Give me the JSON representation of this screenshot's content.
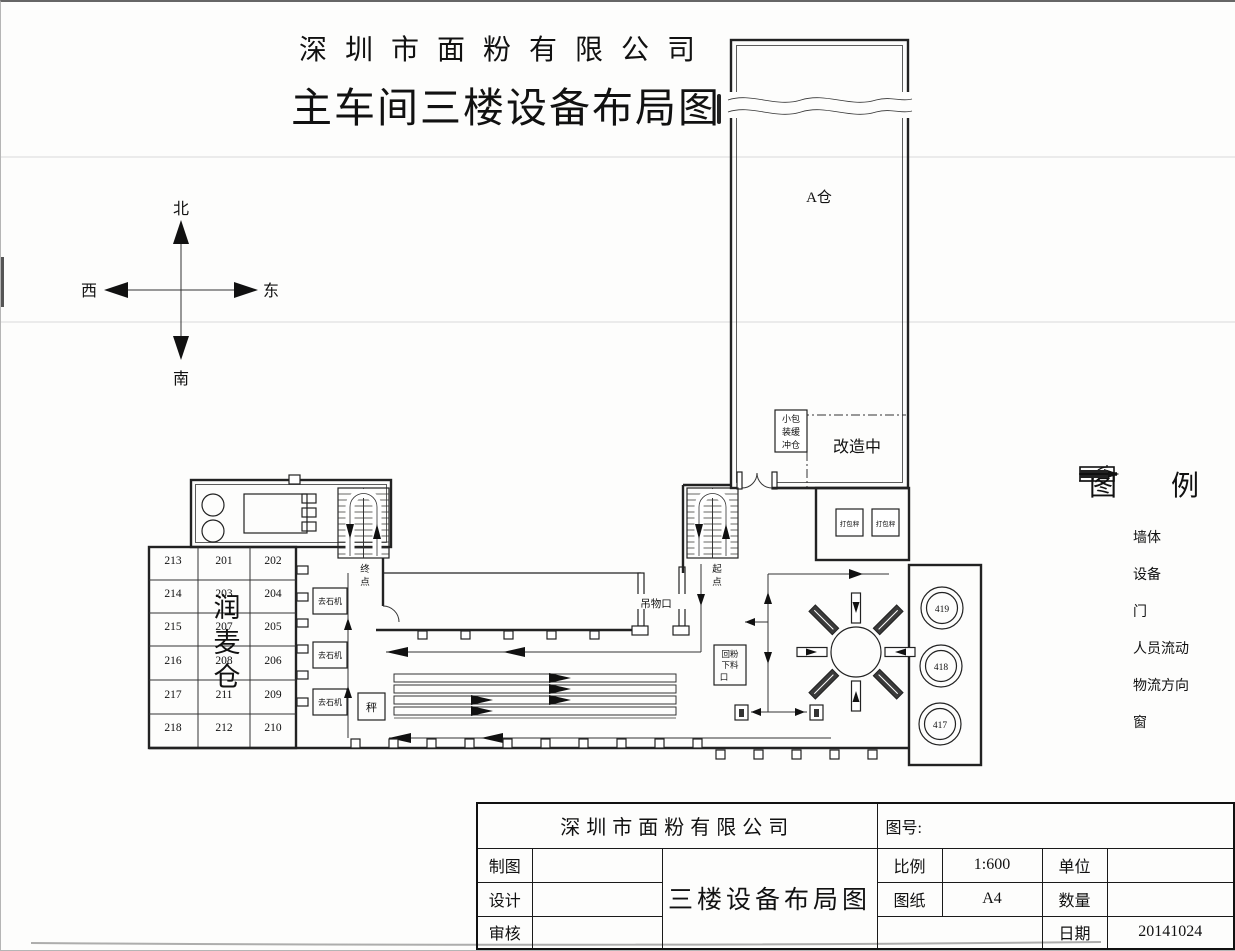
{
  "page": {
    "company": "深圳市面粉有限公司",
    "title": "主车间三楼设备布局图"
  },
  "compass": {
    "north": "北",
    "south": "南",
    "east": "东",
    "west": "西"
  },
  "plan": {
    "warehouse_a_label": "A仓",
    "renovation_label": "改造中",
    "small_pack_buffer_lines": [
      "小包",
      "装缓",
      "冲仓"
    ],
    "packing_scale_label": "打包秤",
    "hoist_opening_label": "吊物口",
    "return_flour_lines": [
      "回粉",
      "下料",
      "口"
    ],
    "start_point_chars": [
      "起",
      "点"
    ],
    "end_point_chars": [
      "终",
      "点"
    ],
    "destoner_label": "去石机",
    "scale_box_label": "秤",
    "tempering_chars": [
      "润",
      "麦",
      "仓"
    ],
    "room_grid": [
      [
        "213",
        "201",
        "202"
      ],
      [
        "214",
        "203",
        "204"
      ],
      [
        "215",
        "207",
        "205"
      ],
      [
        "216",
        "208",
        "206"
      ],
      [
        "217",
        "211",
        "209"
      ],
      [
        "218",
        "212",
        "210"
      ]
    ],
    "silo_labels": [
      "419",
      "418",
      "417"
    ]
  },
  "legend": {
    "title_chars": [
      "图",
      "例"
    ],
    "items": [
      {
        "name": "wall",
        "label": "墙体"
      },
      {
        "name": "equipment",
        "label": "设备"
      },
      {
        "name": "door",
        "label": "门"
      },
      {
        "name": "person-flow",
        "label": "人员流动"
      },
      {
        "name": "material-flow",
        "label": "物流方向"
      },
      {
        "name": "window",
        "label": "窗"
      }
    ]
  },
  "title_block": {
    "company": "深圳市面粉有限公司",
    "drawing_no_label": "图号:",
    "drawing_title": "三楼设备布局图",
    "draft_label": "制图",
    "design_label": "设计",
    "review_label": "审核",
    "scale_label": "比例",
    "scale_value": "1:600",
    "paper_label": "图纸",
    "paper_value": "A4",
    "unit_label": "单位",
    "quantity_label": "数量",
    "date_label": "日期",
    "date_value": "20141024"
  }
}
